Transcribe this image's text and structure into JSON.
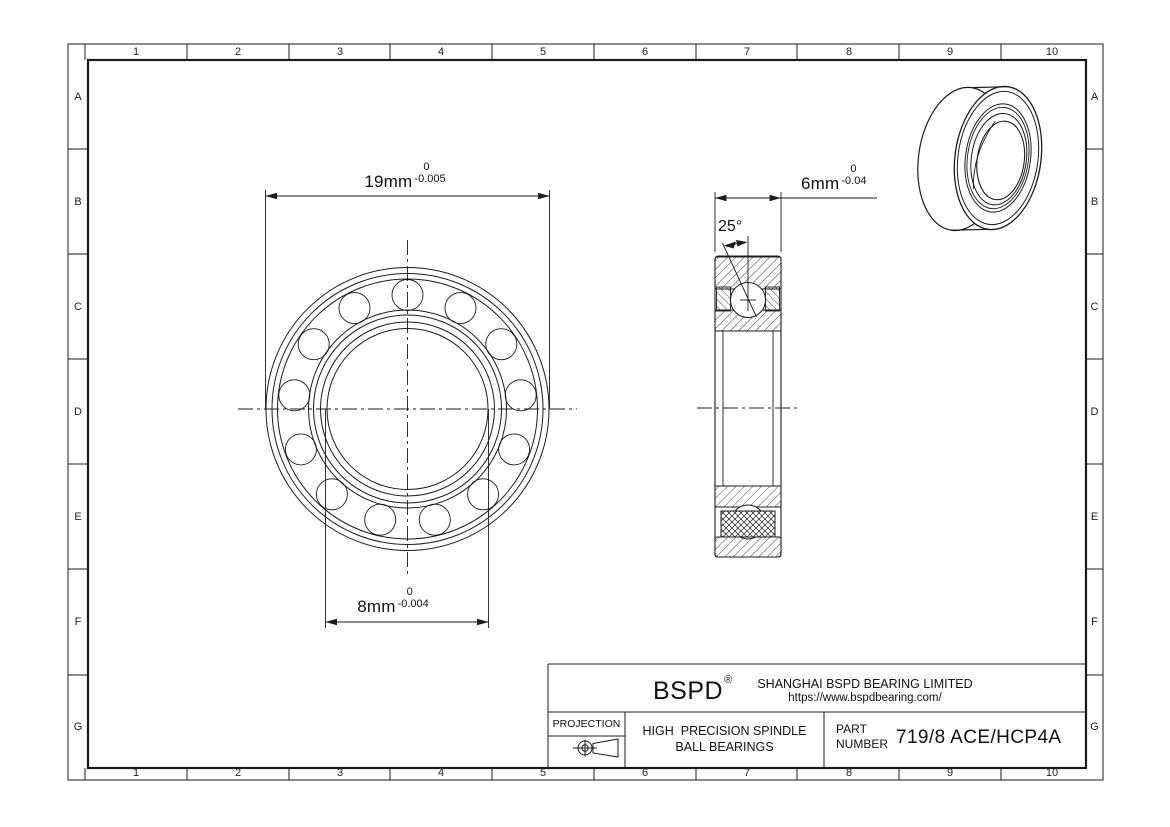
{
  "frame": {
    "columns": [
      "1",
      "2",
      "3",
      "4",
      "5",
      "6",
      "7",
      "8",
      "9",
      "10"
    ],
    "rows": [
      "A",
      "B",
      "C",
      "D",
      "E",
      "F",
      "G"
    ]
  },
  "dimensions": {
    "outer_diameter": {
      "value": "19mm",
      "tolerance_upper": "0",
      "tolerance_lower": "-0.005"
    },
    "bore_diameter": {
      "value": "8mm",
      "tolerance_upper": "0",
      "tolerance_lower": "-0.004"
    },
    "width": {
      "value": "6mm",
      "tolerance_upper": "0",
      "tolerance_lower": "-0.04"
    },
    "contact_angle": {
      "value": "25°"
    }
  },
  "title_block": {
    "brand": "BSPD",
    "registered_mark": "®",
    "company_name": "SHANGHAI BSPD BEARING LIMITED",
    "website": "https://www.bspdbearing.com/",
    "projection_label": "PROJECTION",
    "product_line_1": "HIGH  PRECISION SPINDLE",
    "product_line_2": "BALL BEARINGS",
    "part_label_1": "PART",
    "part_label_2": "NUMBER",
    "part_number": "719/8 ACE/HCP4A"
  },
  "colors": {
    "line": "#1b1b1b",
    "background": "#ffffff"
  }
}
